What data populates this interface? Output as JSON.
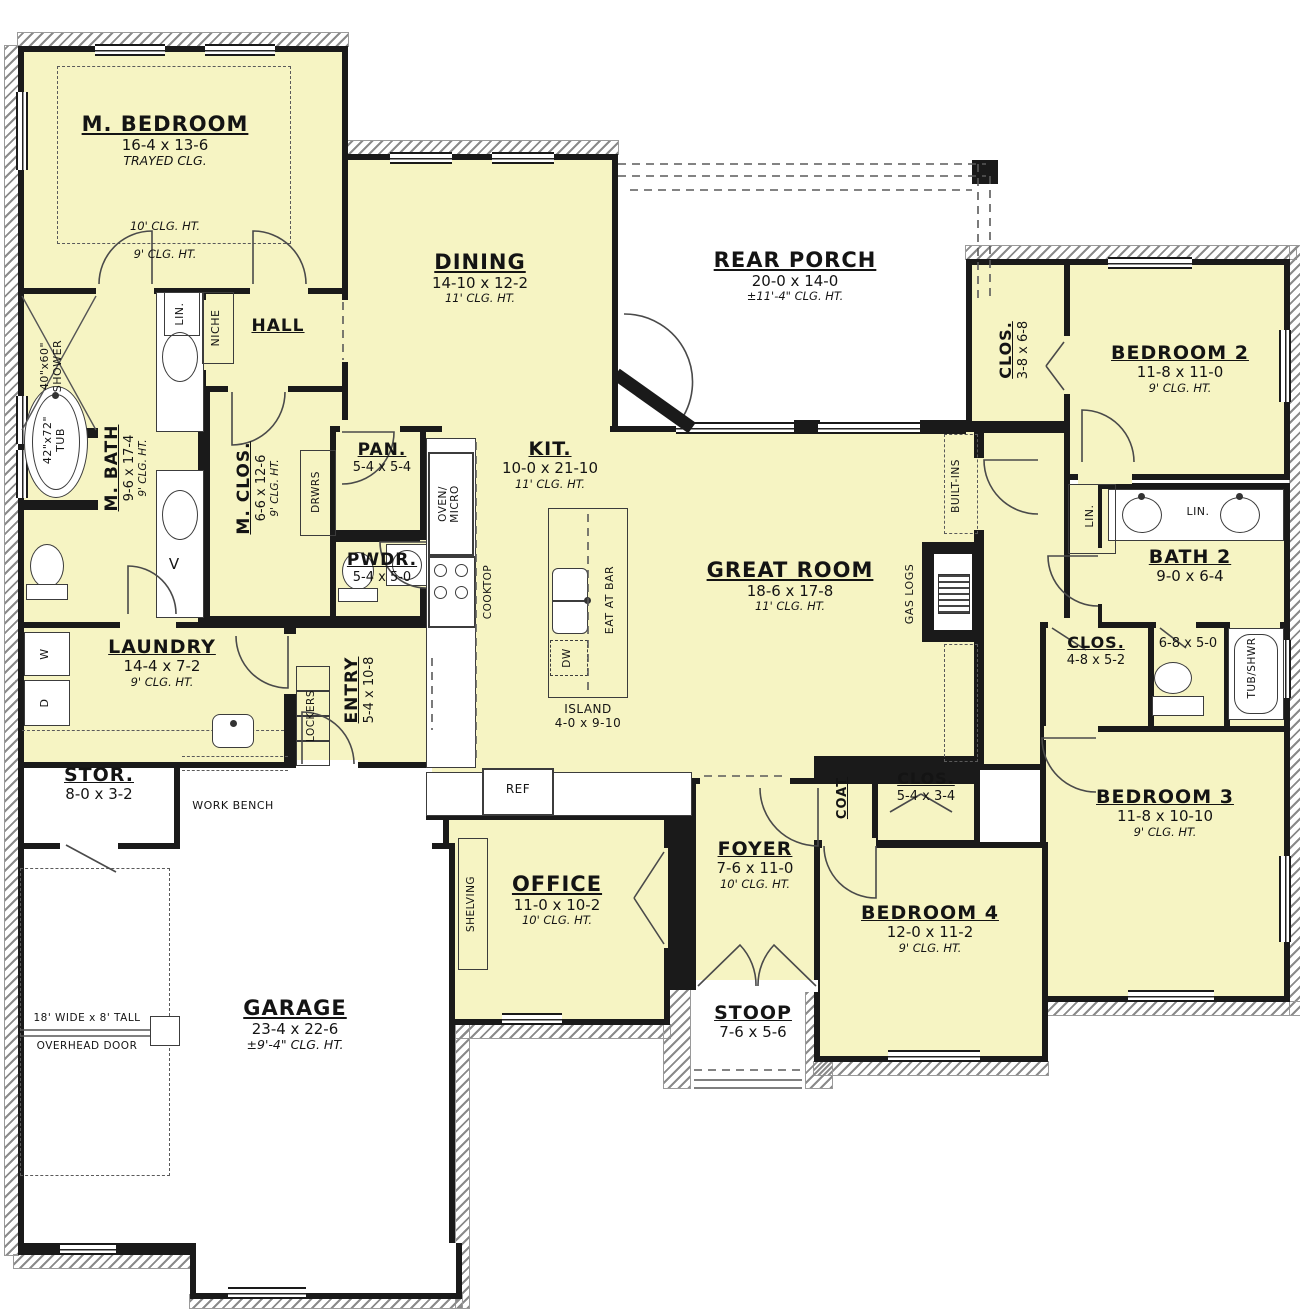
{
  "plan": {
    "rooms": {
      "m_bedroom": {
        "name": "M. BEDROOM",
        "dims": "16-4 x 13-6",
        "note": "TRAYED CLG.",
        "clg_upper": "10' CLG. HT.",
        "clg_lower": "9' CLG. HT."
      },
      "dining": {
        "name": "DINING",
        "dims": "14-10 x 12-2",
        "clg": "11' CLG. HT."
      },
      "rear_porch": {
        "name": "REAR PORCH",
        "dims": "20-0 x 14-0",
        "clg": "±11'-4\" CLG. HT."
      },
      "bedroom2": {
        "name": "BEDROOM 2",
        "dims": "11-8 x 11-0",
        "clg": "9' CLG. HT."
      },
      "clos_bedroom2": {
        "name": "CLOS.",
        "dims": "3-8 x 6-8"
      },
      "hall": {
        "name": "HALL"
      },
      "m_bath": {
        "name": "M. BATH",
        "dims": "9-6 x 17-4",
        "clg": "9' CLG. HT."
      },
      "m_clos": {
        "name": "M. CLOS.",
        "dims": "6-6 x 12-6",
        "clg": "9' CLG. HT."
      },
      "pantry": {
        "name": "PAN.",
        "dims": "5-4 x 5-4"
      },
      "kitchen": {
        "name": "KIT.",
        "dims": "10-0 x 21-10",
        "clg": "11' CLG. HT."
      },
      "powder": {
        "name": "PWDR.",
        "dims": "5-4 x 5-0"
      },
      "great_room": {
        "name": "GREAT ROOM",
        "dims": "18-6 x 17-8",
        "clg": "11' CLG. HT."
      },
      "laundry": {
        "name": "LAUNDRY",
        "dims": "14-4 x 7-2",
        "clg": "9' CLG. HT."
      },
      "entry": {
        "name": "ENTRY",
        "dims": "5-4 x 10-8"
      },
      "bath2": {
        "name": "BATH 2",
        "dims": "9-0 x 6-4"
      },
      "clos_hall": {
        "name": "CLOS.",
        "dims": "4-8 x 5-2"
      },
      "toilet_room": {
        "dims": "6-8 x 5-0"
      },
      "bedroom3": {
        "name": "BEDROOM 3",
        "dims": "11-8 x 10-10",
        "clg": "9' CLG. HT."
      },
      "clos_bedroom4": {
        "name": "CLOS.",
        "dims": "5-4 x 3-4"
      },
      "coat": {
        "name": "COAT"
      },
      "bedroom4": {
        "name": "BEDROOM 4",
        "dims": "12-0 x 11-2",
        "clg": "9' CLG. HT."
      },
      "foyer": {
        "name": "FOYER",
        "dims": "7-6 x 11-0",
        "clg": "10' CLG. HT."
      },
      "office": {
        "name": "OFFICE",
        "dims": "11-0 x 10-2",
        "clg": "10' CLG. HT."
      },
      "stoop": {
        "name": "STOOP",
        "dims": "7-6 x 5-6"
      },
      "storage": {
        "name": "STOR.",
        "dims": "8-0 x 3-2"
      },
      "garage": {
        "name": "GARAGE",
        "dims": "23-4 x 22-6",
        "clg": "±9'-4\" CLG. HT."
      },
      "island": {
        "name": "ISLAND",
        "dims": "4-0 x 9-10"
      }
    },
    "fixtures": {
      "shower_size": "40\"x60\"",
      "shower_word": "SHOWER",
      "tub_size": "42\"x72\"",
      "tub_word": "TUB",
      "linen": "LIN.",
      "linen2": "LIN.",
      "linen3": "LIN.",
      "niche": "NICHE",
      "drawers": "DRWRS",
      "vanity": "V",
      "washer": "W",
      "dryer": "D",
      "lockers": "LOCKERS",
      "work_bench": "WORK BENCH",
      "oven": "OVEN/",
      "micro": "MICRO",
      "cooktop": "COOKTOP",
      "eat_at_bar": "EAT AT BAR",
      "dishwasher": "DW",
      "fridge": "REF",
      "gas_logs": "GAS LOGS",
      "built_ins": "BUILT-INS",
      "tub_shower": "TUB/SHWR",
      "shelving": "SHELVING",
      "overhead_door_line1": "18' WIDE x 8' TALL",
      "overhead_door_line2": "OVERHEAD DOOR"
    }
  }
}
